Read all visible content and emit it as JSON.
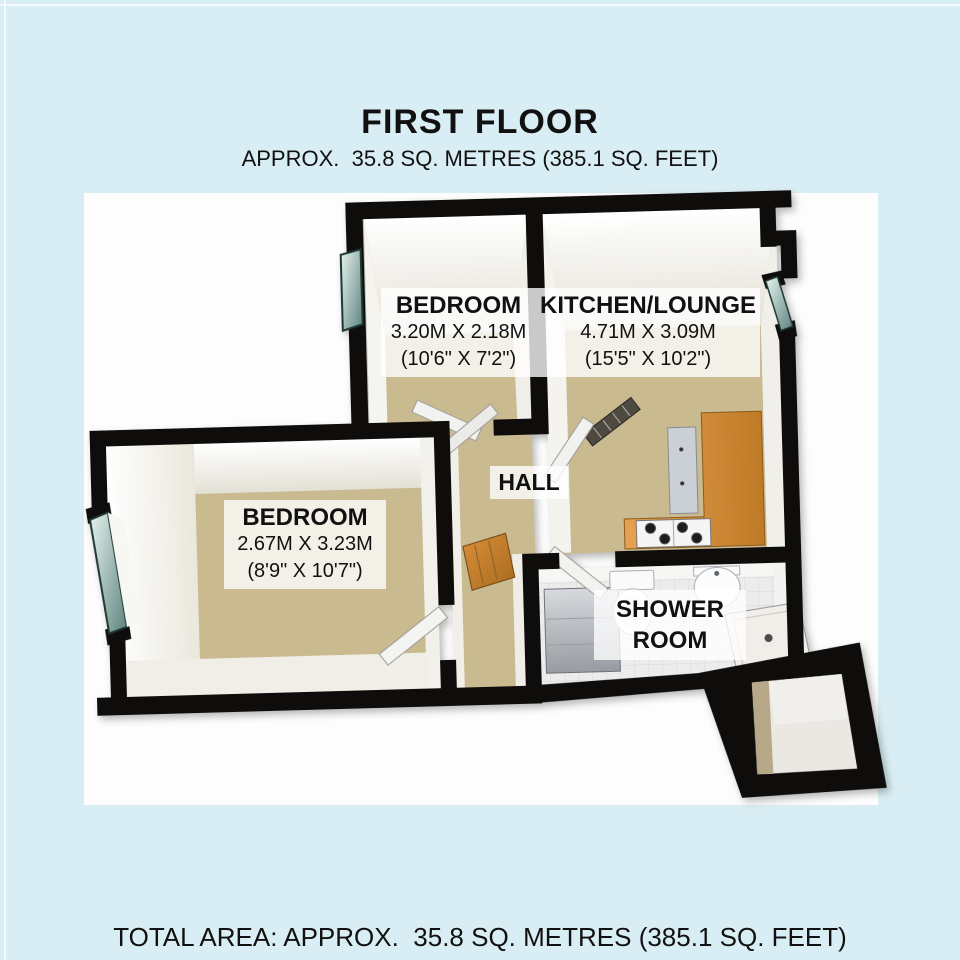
{
  "page": {
    "background_color": "#d9eef4",
    "panel_color": "#fdfdfd"
  },
  "header": {
    "title": "FIRST FLOOR",
    "subtitle": "APPROX.  35.8 SQ. METRES (385.1 SQ. FEET)"
  },
  "footer": {
    "total_area": "TOTAL AREA: APPROX.  35.8 SQ. METRES (385.1 SQ. FEET)"
  },
  "rooms": [
    {
      "name": "BEDROOM",
      "dim_metric": "3.20M X 2.18M",
      "dim_imperial": "(10'6\" X 7'2\")"
    },
    {
      "name": "KITCHEN/LOUNGE",
      "dim_metric": "4.71M X 3.09M",
      "dim_imperial": "(15'5\" X 10'2\")"
    },
    {
      "name": "BEDROOM",
      "dim_metric": "2.67M X 3.23M",
      "dim_imperial": "(8'9\" X 10'7\")"
    },
    {
      "name": "HALL"
    },
    {
      "name": "SHOWER ROOM",
      "line1": "SHOWER",
      "line2": "ROOM"
    }
  ],
  "colors": {
    "wall": "#0f0d0b",
    "floor_carpet": "#c9ba90",
    "tile_floor": "#ececec",
    "kitchen_counter": "#d8913c",
    "window_glass": "#9fc4bd",
    "label_background": "rgba(255,255,255,0.78)"
  }
}
